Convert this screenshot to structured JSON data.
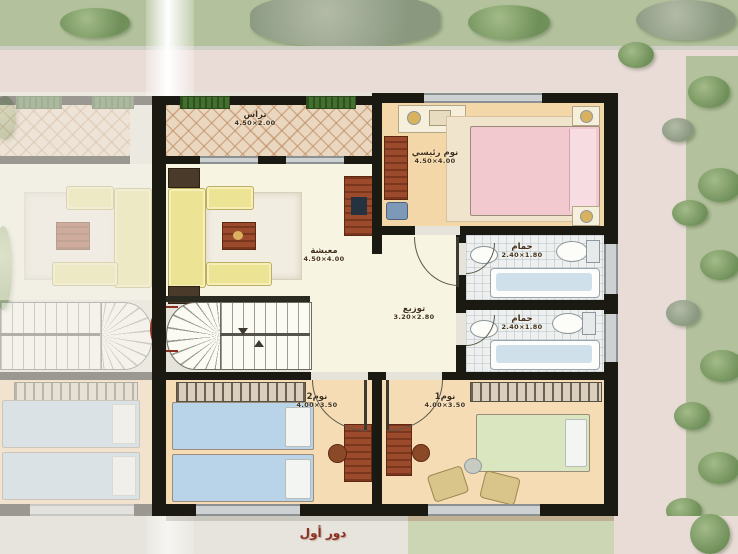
{
  "caption": "دور أول",
  "rooms": {
    "terrace": {
      "label": "تراس",
      "dims": "4.50×2.00"
    },
    "living": {
      "label": "معيشة",
      "dims": "4.50×4.00"
    },
    "master": {
      "label": "نوم رئيسي",
      "dims": "4.50×4.00"
    },
    "hall": {
      "label": "توزيع",
      "dims": "3.20×2.80"
    },
    "bath_top": {
      "label": "حمام",
      "dims": "2.40×1.80"
    },
    "bath_bottom": {
      "label": "حمام",
      "dims": "2.40×1.80"
    },
    "bed2": {
      "label": "نوم2",
      "dims": "4.00×3.50"
    },
    "bed1": {
      "label": "نوم1",
      "dims": "4.00×3.50"
    }
  },
  "colors": {
    "wall": "#1b1a12",
    "floor_cream": "#f7f4e2",
    "floor_peach": "#f4d7a8",
    "terrace_tile": "#ead7c0",
    "grass": "#b3c29c",
    "path_pink": "#e9dcd7",
    "bed_pink": "#f2c9ce",
    "bed_blue": "#b9d3e8",
    "bed_green": "#d9e6c0",
    "sofa_yellow": "#ece394",
    "wood_red": "#9c4a2c",
    "caption_text": "#8a3020"
  }
}
